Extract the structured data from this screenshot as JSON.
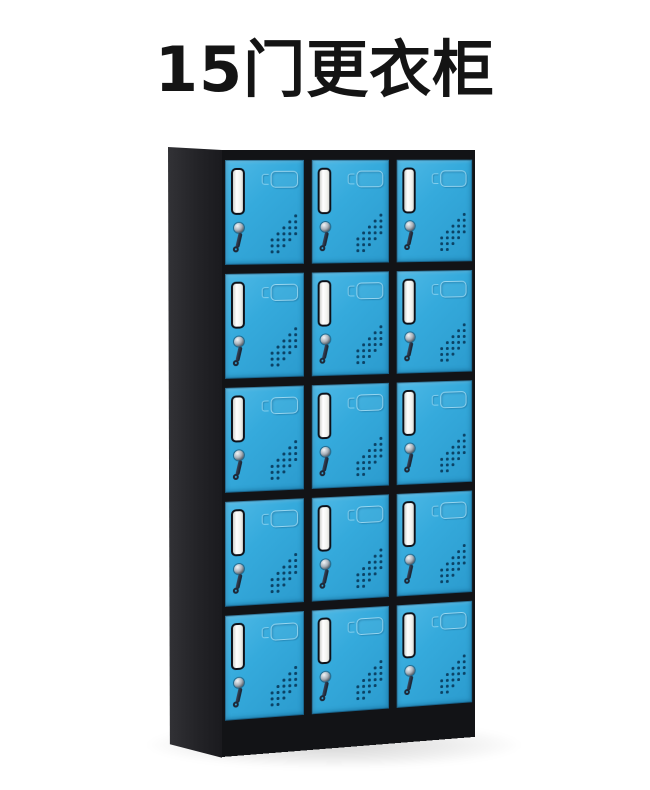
{
  "title": "15门更衣柜",
  "product": {
    "name": "15门更衣柜",
    "door_count": 15,
    "grid": {
      "rows": 5,
      "columns": 3
    }
  },
  "colors": {
    "door_blue": "#35aadc",
    "frame_black": "#121316",
    "label_card_white": "#f2f3ef",
    "background": "#ffffff",
    "title_text": "#141414"
  }
}
